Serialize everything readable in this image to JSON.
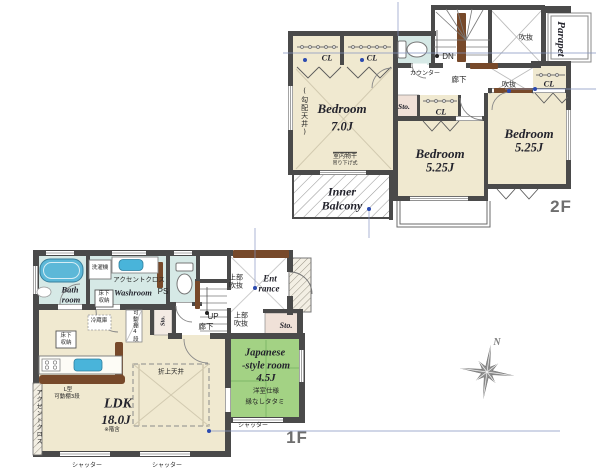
{
  "colors": {
    "wall": "#4a4a4a",
    "floor_cream": "#f0e9d0",
    "tatami_green": "#a3d284",
    "water_blue": "#d6e9e6",
    "tub_blue": "#5cb8d8",
    "storage_pink": "#f0e1d8",
    "wood_brown": "#77492a",
    "dimension_blue": "#2c4bb0",
    "floor_label_gray": "#6e6e6e"
  },
  "f2": {
    "floor_label": "2F",
    "bedroom1": {
      "name": "Bedroom",
      "size": "7.0J"
    },
    "bedroom2": {
      "name": "Bedroom",
      "size": "5.25J"
    },
    "bedroom3": {
      "name": "Bedroom",
      "size": "5.25J"
    },
    "inner_balcony_1": "Inner",
    "inner_balcony_2": "Balcony",
    "parapet": "Parapet",
    "cl": "CL",
    "sto": "Sto.",
    "dn": "DN",
    "counter": "カウンター",
    "hallway": "廊下",
    "void_label": "吹抜",
    "sloped_ceiling": "(勾配天井)",
    "laundry_1": "室内物干",
    "laundry_2": "吊り下げ式"
  },
  "f1": {
    "floor_label": "1F",
    "bath_1": "Bath",
    "bath_2": "room",
    "washroom": "Washroom",
    "ps": "PS",
    "washer": "洗濯機",
    "accent_cloth": "アクセントクロス",
    "underfloor_1": "床下",
    "underfloor_2": "収納",
    "fridge": "冷蔵庫",
    "shelf4": "可動棚4段",
    "sto": "Sto.",
    "up": "UP",
    "hallway": "廊下",
    "upper_void_1": "上部",
    "upper_void_2": "吹抜",
    "entrance_1": "Ent",
    "entrance_2": "rance",
    "jroom_1": "Japanese",
    "jroom_2": "-style room",
    "jroom_3": "4.5J",
    "jroom_note_1": "洋室仕様",
    "jroom_note_2": "縁なしタタミ",
    "ldk_name": "LDK",
    "ldk_size": "18.0J",
    "ldk_note": "※階含",
    "ltype_1": "L型",
    "ltype_2": "可動棚3段",
    "coffered": "折上天井",
    "shutter": "シャッター"
  },
  "compass": {
    "north": "N"
  }
}
